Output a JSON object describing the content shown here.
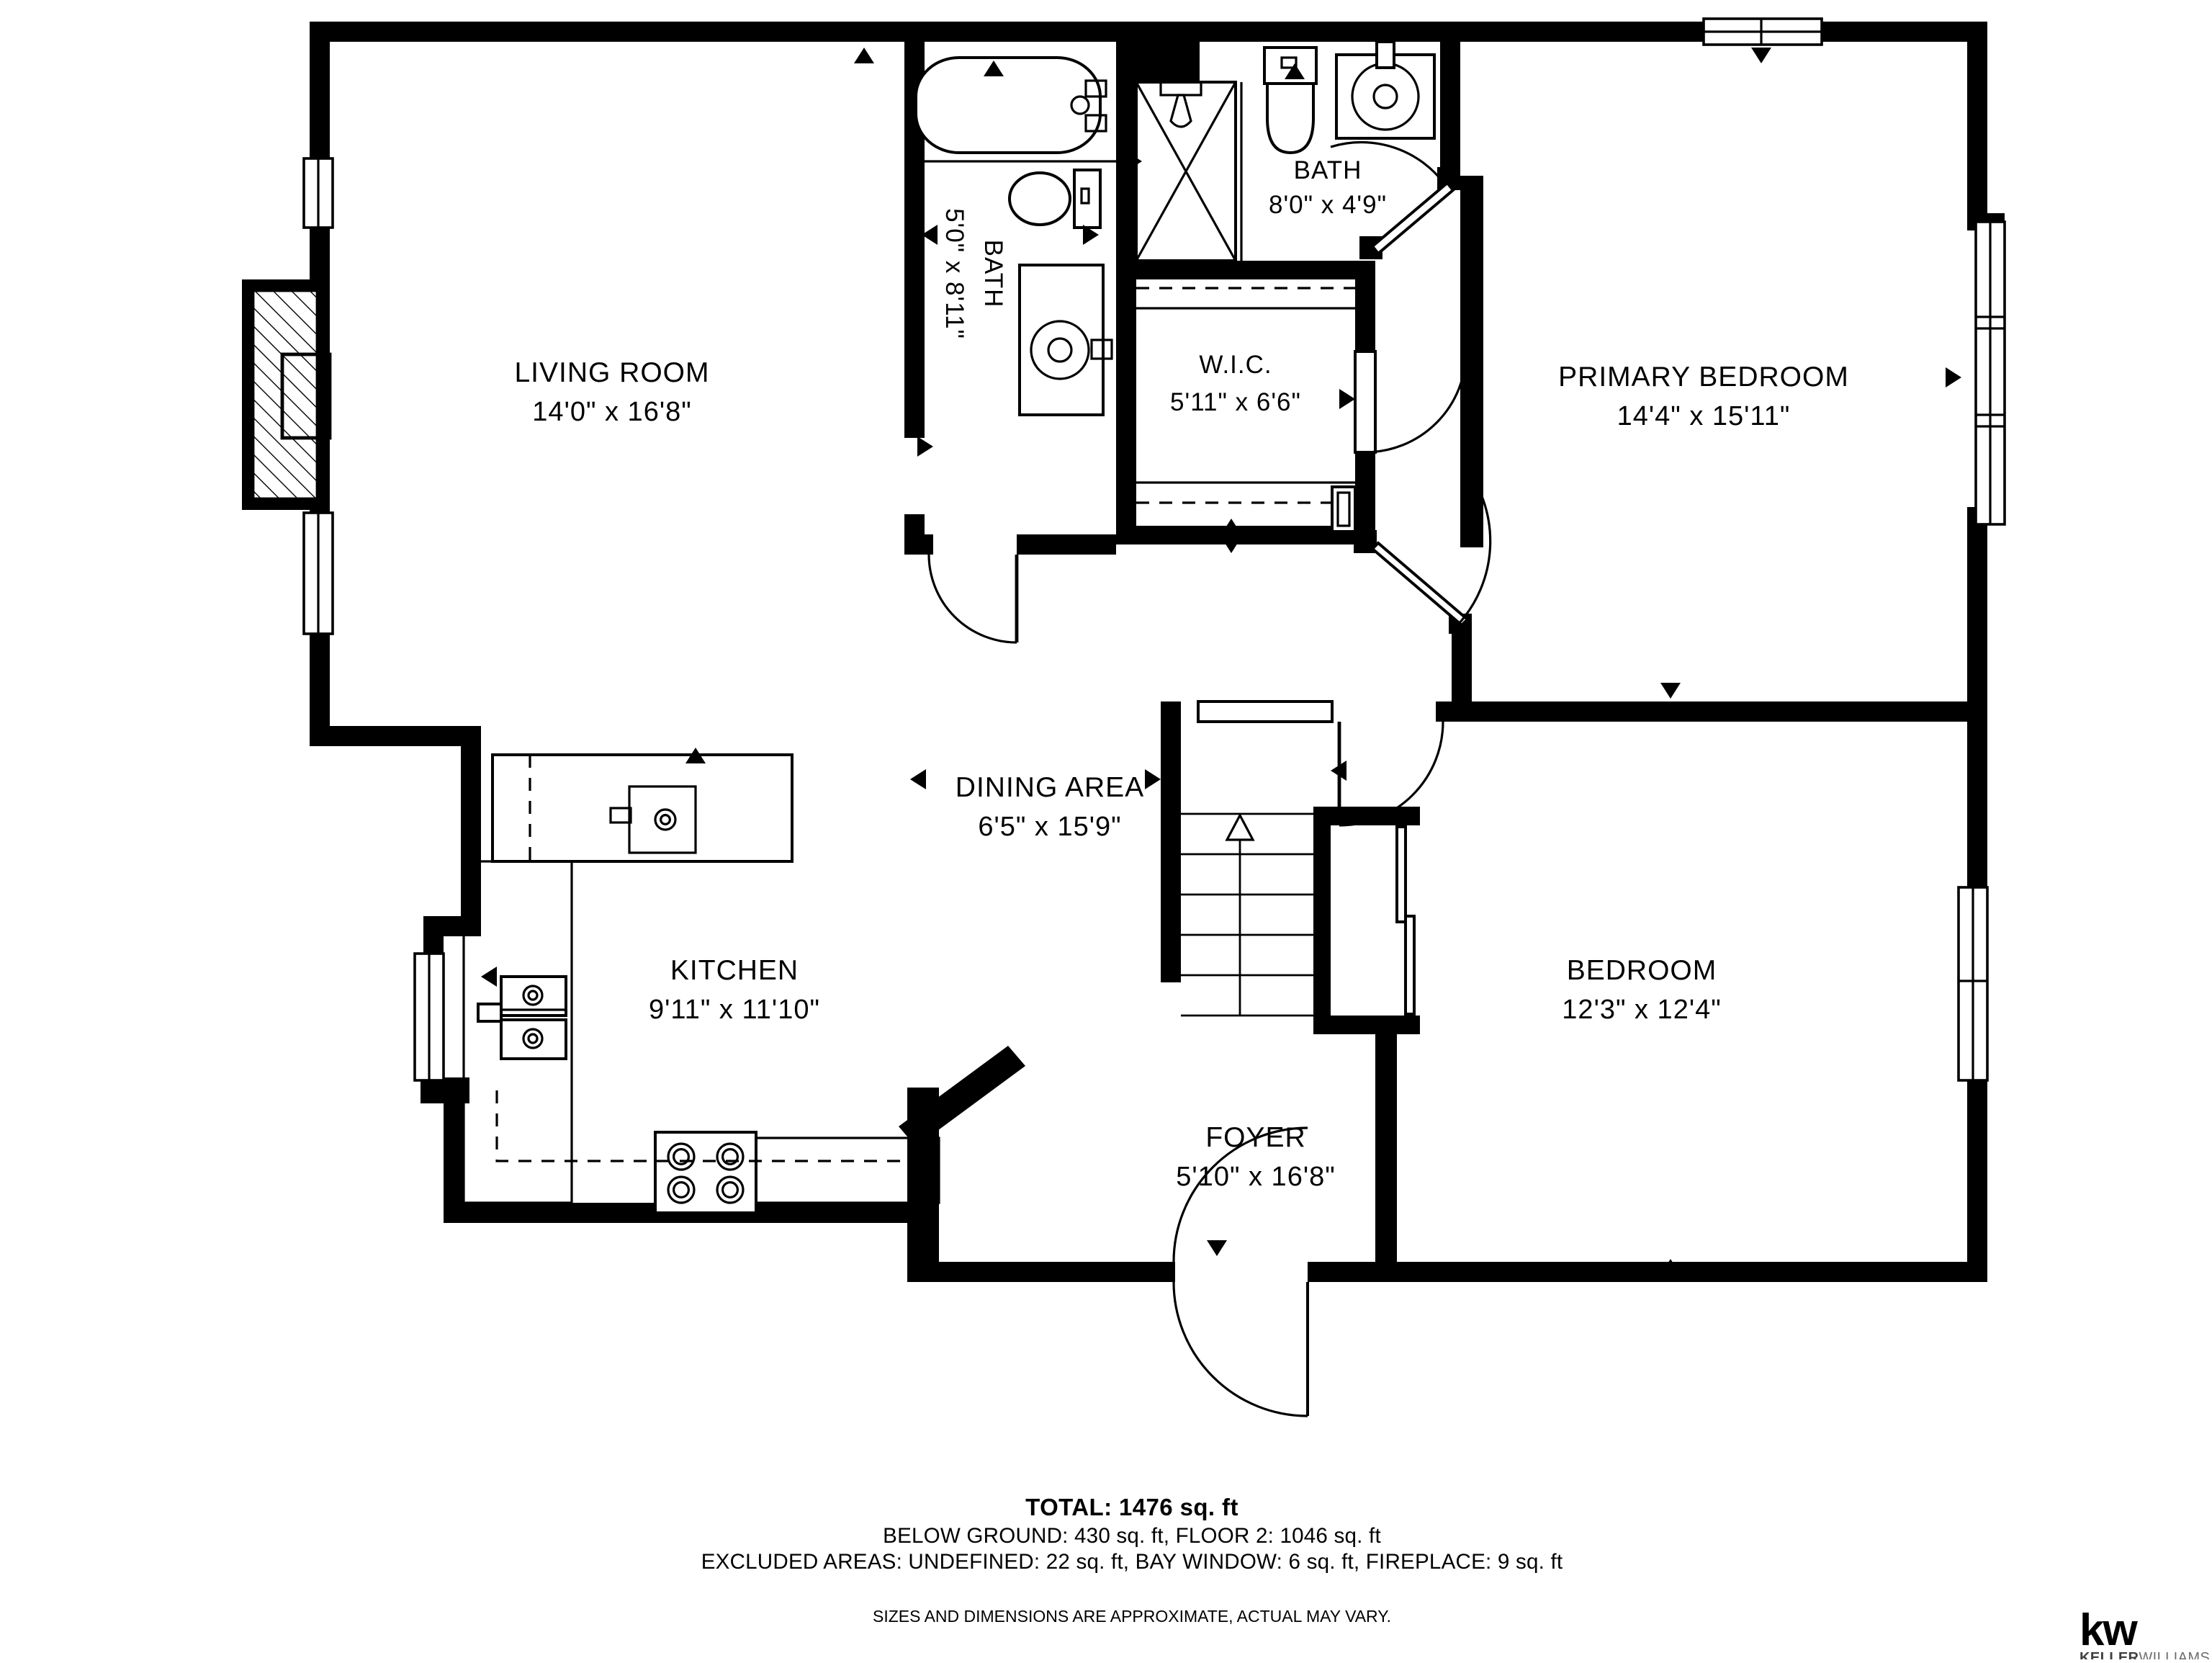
{
  "rooms": {
    "living": {
      "name": "LIVING ROOM",
      "dims": "14'0\" x 16'8\""
    },
    "bath1": {
      "name": "BATH",
      "dims": "5'0\" x 8'11\""
    },
    "bath2": {
      "name": "BATH",
      "dims": "8'0\" x 4'9\""
    },
    "wic": {
      "name": "W.I.C.",
      "dims": "5'11\" x 6'6\""
    },
    "primary": {
      "name": "PRIMARY BEDROOM",
      "dims": "14'4\" x 15'11\""
    },
    "dining": {
      "name": "DINING AREA",
      "dims": "6'5\" x 15'9\""
    },
    "kitchen": {
      "name": "KITCHEN",
      "dims": "9'11\" x 11'10\""
    },
    "bedroom": {
      "name": "BEDROOM",
      "dims": "12'3\" x 12'4\""
    },
    "foyer": {
      "name": "FOYER",
      "dims": "5'10\" x 16'8\""
    }
  },
  "footer": {
    "total": "TOTAL: 1476 sq. ft",
    "line2": "BELOW GROUND: 430 sq. ft, FLOOR 2: 1046 sq. ft",
    "line3": "EXCLUDED AREAS: UNDEFINED: 22 sq. ft, BAY WINDOW: 6 sq. ft, FIREPLACE: 9 sq. ft",
    "disclaimer": "SIZES AND DIMENSIONS ARE APPROXIMATE, ACTUAL MAY VARY."
  },
  "logo": {
    "mark": "kw",
    "name_bold": "KELLER",
    "name_light": "WILLIAMS.",
    "brand_color": "#bf1e2e",
    "text_color": "#404041"
  }
}
